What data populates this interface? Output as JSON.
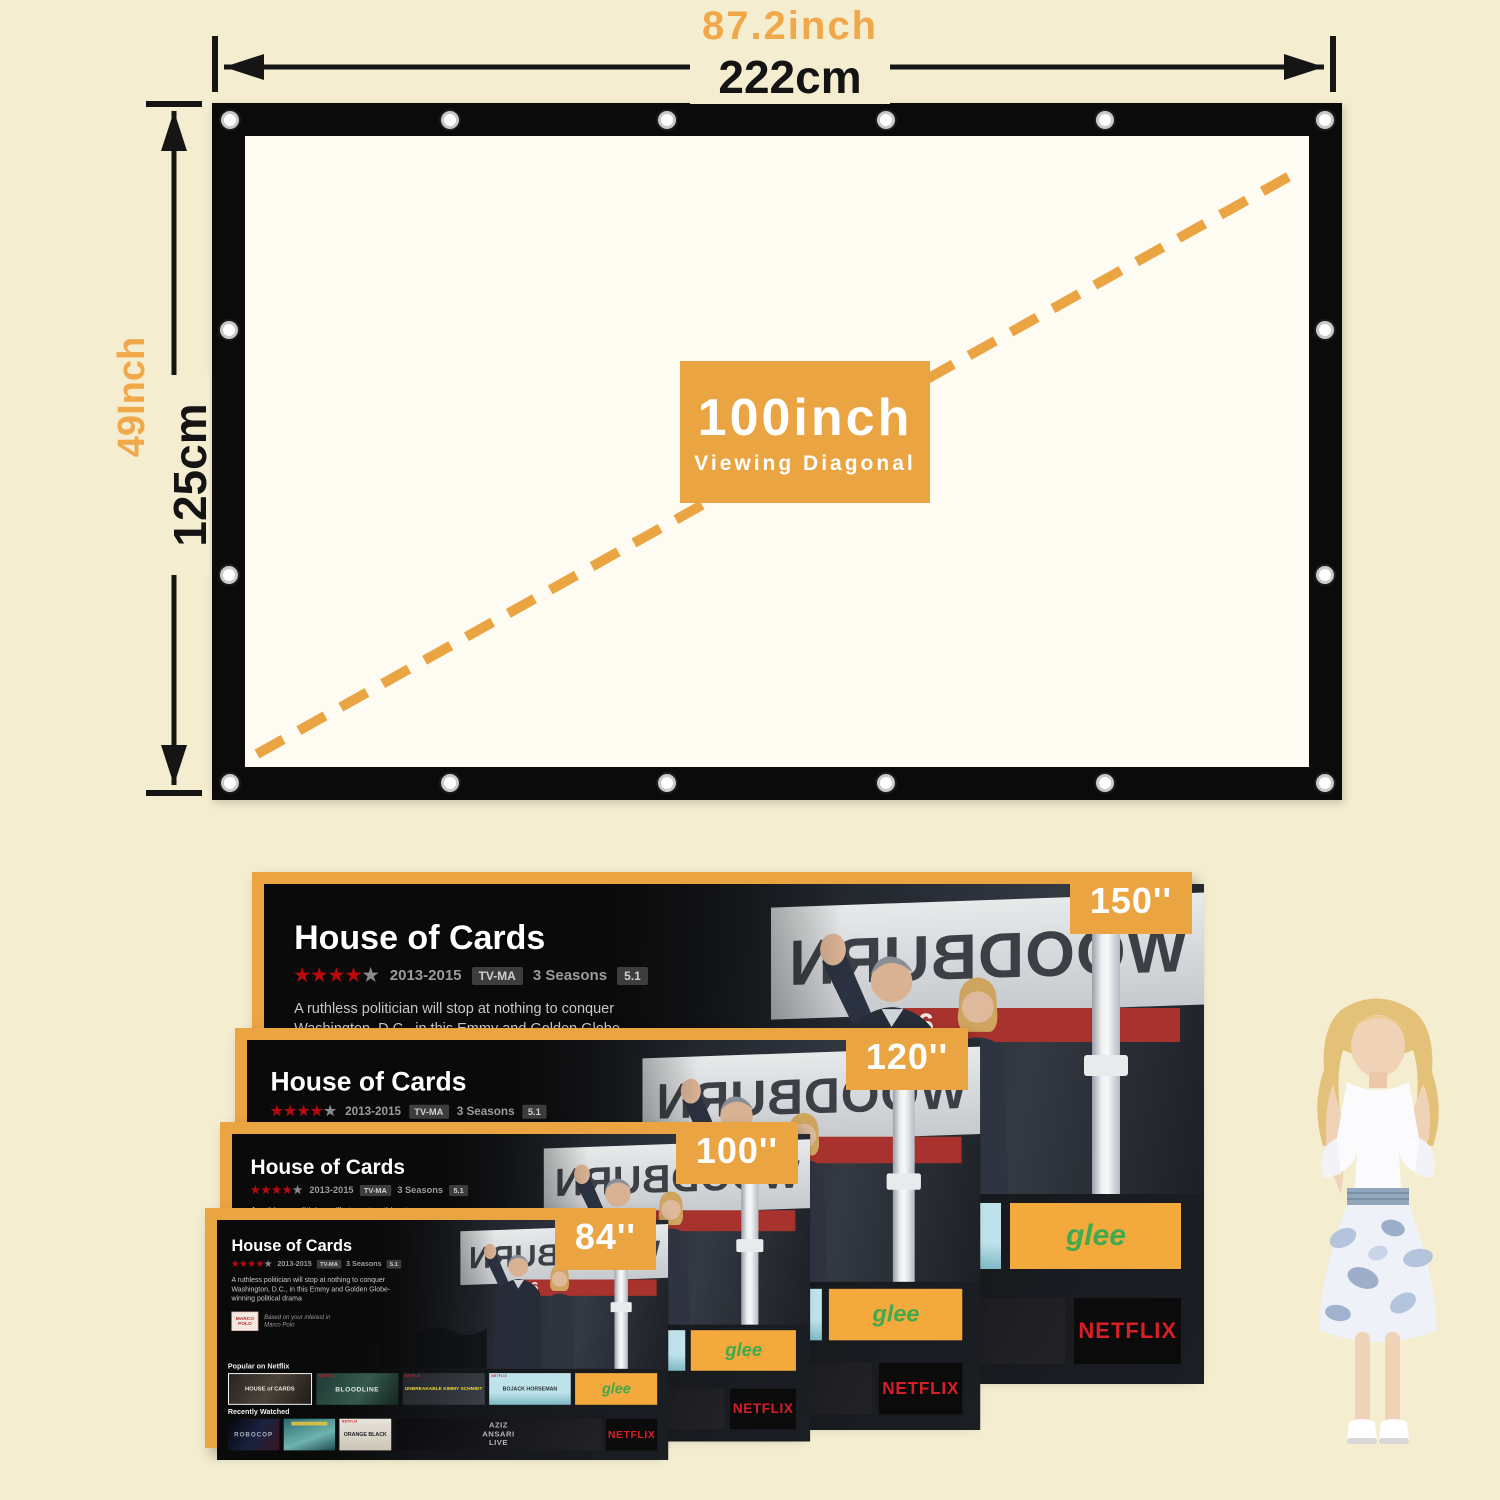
{
  "colors": {
    "background": "#F4EDD0",
    "accent_orange": "#EBA442",
    "screen_border": "#0B0B0B",
    "netflix_red": "#D81F26"
  },
  "dimension_diagram": {
    "width_inch": "87.2inch",
    "width_cm": "222cm",
    "height_inch": "49Inch",
    "height_cm": "125cm",
    "diagonal_value": "100inch",
    "diagonal_caption": "Viewing Diagonal"
  },
  "size_comparison": {
    "screens": [
      {
        "label": "150''"
      },
      {
        "label": "120''"
      },
      {
        "label": "100''"
      },
      {
        "label": "84''"
      }
    ]
  },
  "netflix_ui": {
    "brand": "NETFLIX",
    "title": "House of Cards",
    "stars_filled": "★★★★",
    "star_empty": "★",
    "years": "2013-2015",
    "maturity": "TV-MA",
    "seasons": "3 Seasons",
    "score": "5.1",
    "description": "A ruthless politician will stop at nothing to conquer Washington, D.C., in this Emmy and Golden Globe-winning political drama",
    "related_poster": "MARCO POLO",
    "related_note": "Based on your interest in Marco Polo",
    "photo_sign": "WOODBURN",
    "sign_number": "6",
    "row1_label": "Popular on Netflix",
    "row1": [
      {
        "title": "HOUSE of CARDS"
      },
      {
        "title": "BLOODLINE"
      },
      {
        "title": "UNBREAKABLE KIMMY SCHMIDT"
      },
      {
        "title": "BOJACK HORSEMAN"
      },
      {
        "title": "glee"
      }
    ],
    "row2_label": "Recently Watched",
    "row2": [
      {
        "title": "ROBOCOP"
      },
      {
        "title": ""
      },
      {
        "title": "ORANGE BLACK"
      },
      {
        "title": "AZIZ ANSARI LIVE"
      },
      {
        "title": "NETFLIX"
      }
    ]
  }
}
